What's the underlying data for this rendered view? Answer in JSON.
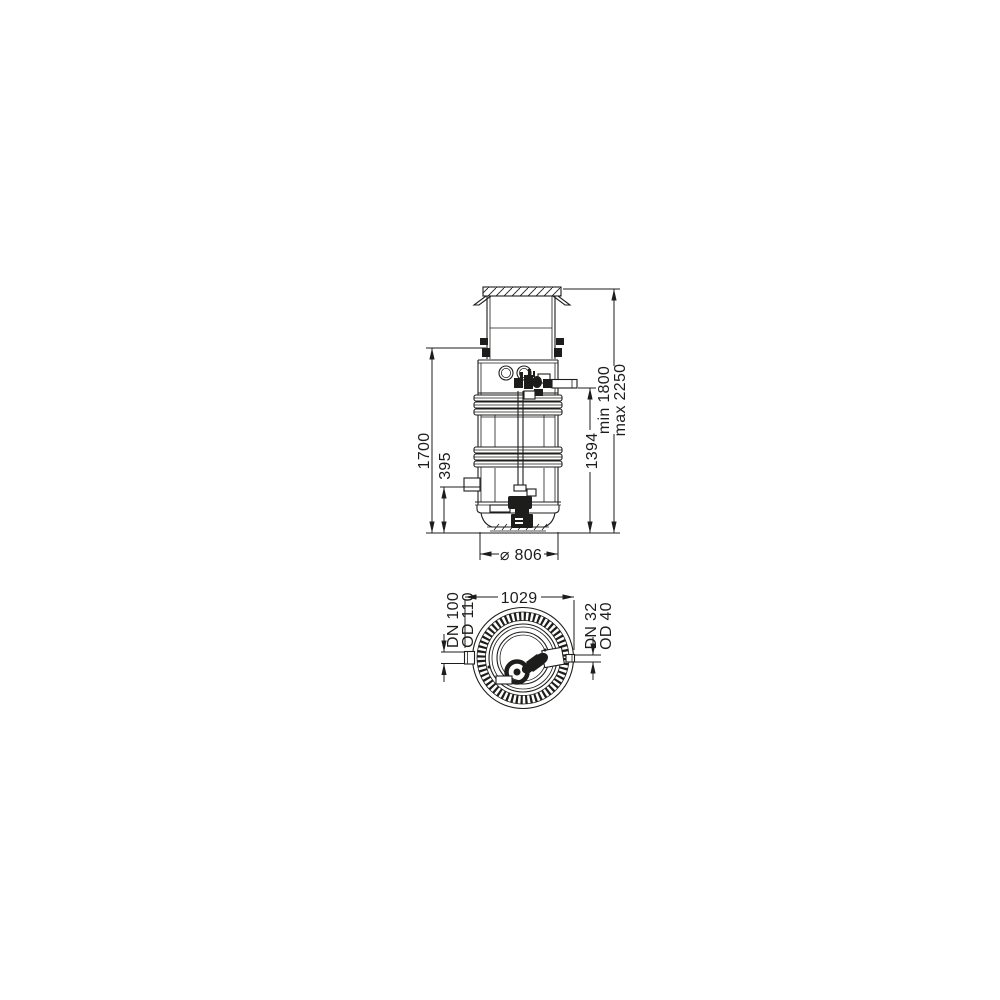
{
  "side_view": {
    "dim_tank_height": "1700",
    "dim_inlet_height": "395",
    "dim_outlet_height": "1394",
    "dim_total_min": "min 1800",
    "dim_total_max": "max 2250",
    "dim_diameter": "⌀ 806"
  },
  "plan_view": {
    "dim_overall_width": "1029",
    "dim_inlet_nominal": "DN 100",
    "dim_inlet_outer": "OD 110",
    "dim_outlet_nominal": "DN 32",
    "dim_outlet_outer": "OD 40"
  },
  "colors": {
    "line": "#1d1d1b",
    "background": "#ffffff"
  }
}
